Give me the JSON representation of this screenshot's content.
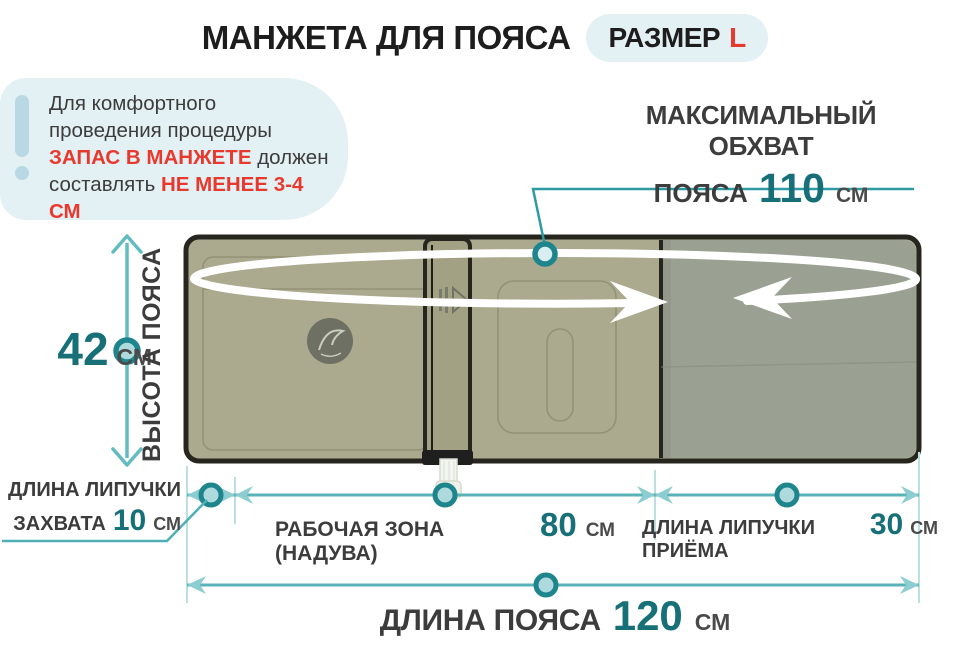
{
  "title": {
    "text": "МАНЖЕТА ДЛЯ ПОЯСА"
  },
  "size_badge": {
    "label": "РАЗМЕР",
    "value": "L"
  },
  "note": {
    "part1": "Для комфортного проведения процедуры",
    "highlight1": "ЗАПАС В МАНЖЕТЕ",
    "part2": "должен составлять",
    "highlight2": "НЕ МЕНЕЕ 3-4 СМ"
  },
  "measurements": {
    "max_girth": {
      "label_line1": "МАКСИМАЛЬНЫЙ ОБХВАТ",
      "label_line2": "ПОЯСА",
      "value": "110",
      "unit": "СМ"
    },
    "belt_height": {
      "label": "ВЫСОТА ПОЯСА",
      "value": "42",
      "unit": "СМ"
    },
    "grip_velcro": {
      "label_line1": "ДЛИНА ЛИПУЧКИ",
      "label_line2": "ЗАХВАТА",
      "value": "10",
      "unit": "СМ"
    },
    "working_zone": {
      "label": "РАБОЧАЯ ЗОНА (НАДУВА)",
      "value": "80",
      "unit": "СМ"
    },
    "receiving_velcro": {
      "label": "ДЛИНА ЛИПУЧКИ ПРИЁМА",
      "value": "30",
      "unit": "СМ"
    },
    "belt_length": {
      "label": "ДЛИНА ПОЯСА",
      "value": "120",
      "unit": "СМ"
    }
  },
  "colors": {
    "accent_teal": "#176F77",
    "dim_line_teal": "#58B2B8",
    "arrow_teal": "#8CCDD1",
    "ring_teal": "#1E858C",
    "red": "#E8392E",
    "badge_bg": "#E4F1F4",
    "cuff_olive": "#ABAA8E",
    "cuff_velcro": "#9BA192",
    "text_dark": "#3C3C3C"
  }
}
